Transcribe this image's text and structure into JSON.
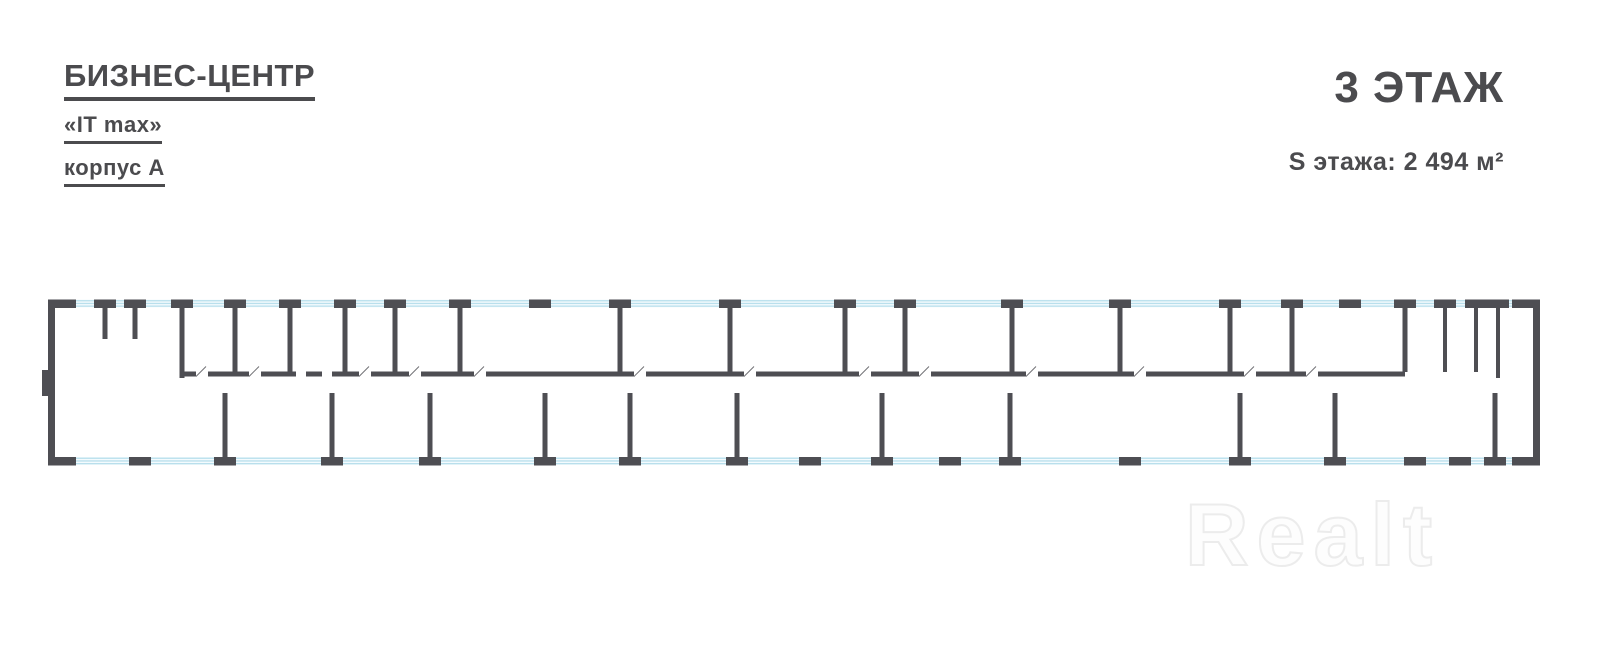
{
  "header": {
    "brand_line1": "БИЗНЕС-ЦЕНТР",
    "brand_line2": "«IT max»",
    "brand_line3": "корпус А"
  },
  "floor_info": {
    "floor_title": "3 ЭТАЖ",
    "floor_area_label": "S этажа: 2 494 м²"
  },
  "watermark": {
    "text": "Realt"
  },
  "colors": {
    "wall": "#4e4e53",
    "window_line": "#b9dfec",
    "window_bg": "#f4fbfe",
    "label_text": "#55555a",
    "label_box_border": "#8e8e93",
    "fixture": "#6a6a6e"
  },
  "plan": {
    "service_rooms": [
      {
        "name": "Санузел",
        "area": "15.79 м²",
        "lx": 80,
        "ly": 316
      },
      {
        "name": "Коридор",
        "area": "8.13 м²",
        "lx": 120,
        "ly": 314
      },
      {
        "name": "Санузел",
        "area": "13.53 м²",
        "lx": 158,
        "ly": 316
      },
      {
        "name": "Переговорная",
        "area": "38.53 м²",
        "lx": 208,
        "ly": 327
      },
      {
        "name": "Кабинет",
        "area": "38.81 м²",
        "lx": 262,
        "ly": 327
      },
      {
        "name": "Санузел",
        "area": "17.23 м²",
        "lx": 318,
        "ly": 321
      },
      {
        "name": "Умывальная",
        "area": "9.28 м²",
        "lx": 303,
        "ly": 354
      },
      {
        "name": "ПУИ",
        "area": "7.01 м²",
        "lx": 331,
        "ly": 354
      },
      {
        "name": "Кабинет",
        "area": "19.63 м²",
        "lx": 370,
        "ly": 319
      },
      {
        "name": "Кабинет",
        "area": "23.48 м²",
        "lx": 370,
        "ly": 352
      },
      {
        "name": "Техническая",
        "area": "40.13 м²",
        "lx": 427,
        "ly": 331
      },
      {
        "name": "Санузел",
        "area": "13.86 м²",
        "lx": 1422,
        "ly": 329
      },
      {
        "name": "Умывальная",
        "area": "6.12 м²",
        "lx": 1418,
        "ly": 356
      },
      {
        "name": "ПУИ",
        "area": "4.36 м²",
        "lx": 1441,
        "ly": 356
      },
      {
        "name": "Коридор",
        "area": "14.31 м²",
        "lx": 1487,
        "ly": 317
      },
      {
        "name": "Санузел",
        "area": "14.97 м²",
        "lx": 1516,
        "ly": 315
      }
    ],
    "top_offices": [
      {
        "name": "Кабинет",
        "area": "41.54 м²",
        "x1": 460,
        "x2": 620
      },
      {
        "name": "Кабинет",
        "area": "46.11 м²",
        "x1": 620,
        "x2": 730
      },
      {
        "name": "Кабинет",
        "area": "51.08 м²",
        "x1": 730,
        "x2": 845
      },
      {
        "name": "Кабинет",
        "area": "20.91 м²",
        "x1": 845,
        "x2": 905
      },
      {
        "name": "Кабинет",
        "area": "57.31 м²",
        "x1": 905,
        "x2": 1012
      },
      {
        "name": "Кабинет",
        "area": "43.07 м²",
        "x1": 1012,
        "x2": 1120
      },
      {
        "name": "Кабинет",
        "area": "37.31 м²",
        "x1": 1120,
        "x2": 1230
      },
      {
        "name": "Кабинет",
        "area": "20.63 м²",
        "x1": 1230,
        "x2": 1292
      },
      {
        "name": "Кабинет",
        "area": "37.85 м²",
        "x1": 1292,
        "x2": 1405
      }
    ],
    "bottom_rooms": [
      {
        "name": "Кабинет",
        "area": "76.31 м²",
        "x1": 55,
        "x2": 225
      },
      {
        "name": "Кабинет",
        "area": "36.86 м²",
        "x1": 225,
        "x2": 332
      },
      {
        "name": "Кабинет",
        "area": "41.50 м²",
        "x1": 332,
        "x2": 430
      },
      {
        "name": "Кабинет",
        "area": "56.05 м²",
        "x1": 430,
        "x2": 545
      },
      {
        "name": "Кабинет",
        "area": "34.27 м²",
        "x1": 545,
        "x2": 630
      },
      {
        "name": "Кабинет",
        "area": "44.77 м²",
        "x1": 630,
        "x2": 737
      },
      {
        "name": "Кабинет",
        "area": "84.44 м²",
        "x1": 737,
        "x2": 882
      },
      {
        "name": "Кабинет",
        "area": "43.89 м²",
        "x1": 882,
        "x2": 1010
      },
      {
        "name": "Кабинет",
        "area": "150.12 м²",
        "x1": 1010,
        "x2": 1240
      },
      {
        "name": "Кабинет",
        "area": "38.34 м²",
        "x1": 1240,
        "x2": 1335
      },
      {
        "name": "Кабинет",
        "area": "150.88 м²",
        "x1": 1335,
        "x2": 1495
      },
      {
        "name": "Кабинет",
        "area": "27.85 м²",
        "x1": 1495,
        "x2": 1533
      }
    ],
    "corridor_labels": [
      {
        "name": "Коридор",
        "area": "107.02 м²",
        "x": 160,
        "y": 379
      },
      {
        "name": "Коридор",
        "area": "377.25 м²",
        "x": 800,
        "y": 379
      },
      {
        "name": "Коридор",
        "area": "105.22 м²",
        "x": 1462,
        "y": 379
      }
    ]
  }
}
